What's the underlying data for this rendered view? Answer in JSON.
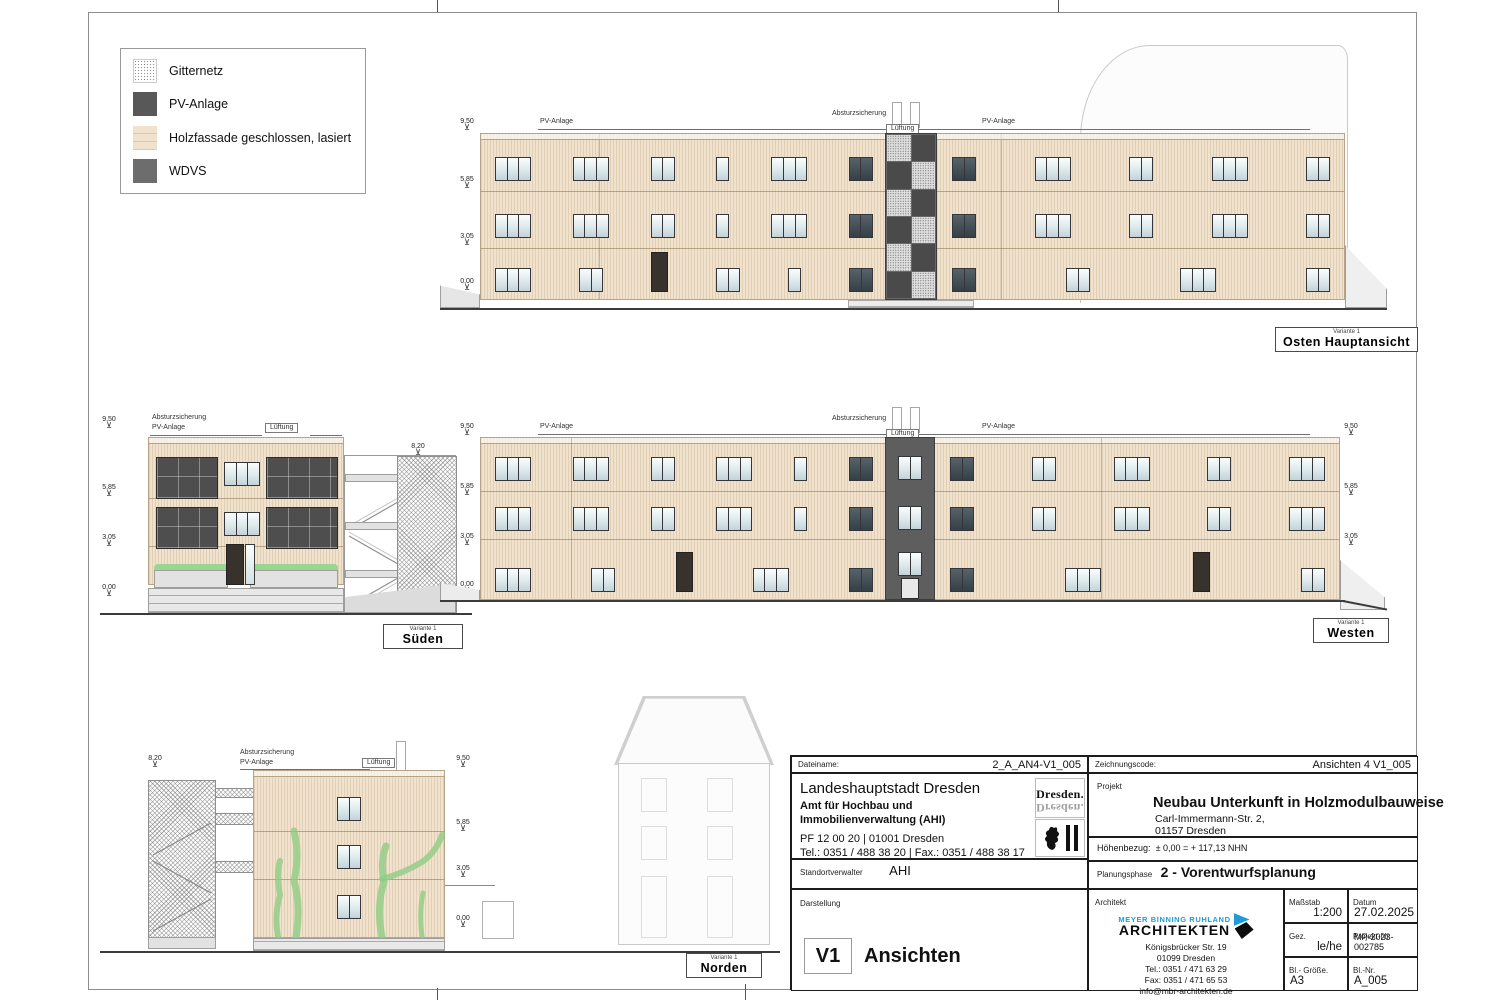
{
  "legend": {
    "items": [
      {
        "label": "Gitternetz"
      },
      {
        "label": "PV-Anlage"
      },
      {
        "label": "Holzfassade geschlossen, lasiert"
      },
      {
        "label": "WDVS"
      }
    ]
  },
  "annotations": {
    "pv_anlage": "PV-Anlage",
    "absturzsicherung": "Absturzsicherung",
    "lueftung": "Lüftung",
    "pflanztrog": "Pflanztrog"
  },
  "levels": {
    "roof": "9,50",
    "l2": "5,85",
    "l1": "3,05",
    "ground": "0,00",
    "tower": "8,20"
  },
  "icons": {
    "level_mark": "⊻"
  },
  "views": {
    "osten": {
      "variant": "Variante 1",
      "title": "Osten Hauptansicht"
    },
    "sueden": {
      "variant": "Variante 1",
      "title": "Süden"
    },
    "westen": {
      "variant": "Variante 1",
      "title": "Westen"
    },
    "norden": {
      "variant": "Variante 1",
      "title": "Norden"
    }
  },
  "titleblock": {
    "dateiname_label": "Dateiname:",
    "dateiname_value": "2_A_AN4-V1_005",
    "zeichnungscode_label": "Zeichnungscode:",
    "zeichnungscode_value": "Ansichten 4 V1_005",
    "client": {
      "name": "Landeshauptstadt Dresden",
      "dept": "Amt für Hochbau und Immobilienverwaltung (AHI)",
      "address": "PF 12 00 20 | 01001 Dresden",
      "phone": "Tel.: 0351 / 488 38 20 | Fax.: 0351 / 488 38 17",
      "logo_text": "Dresden."
    },
    "projekt_label": "Projekt",
    "projekt_name": "Neubau Unterkunft in Holzmodulbauweise",
    "projekt_addr1": "Carl-Immermann-Str. 2,",
    "projekt_addr2": "01157 Dresden",
    "hoehenbezug_label": "Höhenbezug:",
    "hoehenbezug_value": "± 0,00 = + 117,13 NHN",
    "standortverwalter_label": "Standortverwalter",
    "standortverwalter_value": "AHI",
    "planungsphase_label": "Planungsphase",
    "planungsphase_value": "2 - Vorentwurfsplanung",
    "darstellung_label": "Darstellung",
    "darstellung_code": "V1",
    "darstellung_value": "Ansichten",
    "architekt_label": "Architekt",
    "architekt": {
      "logo_line1": "MEYER BINNING RUHLAND",
      "logo_line2": "ARCHITEKTEN",
      "addr1": "Königsbrücker Str. 19",
      "addr2": "01099 Dresden",
      "tel": "Tel.: 0351 / 471 63 29",
      "fax": "Fax: 0351 / 471 65 53",
      "email": "info@mbr-architekten.de"
    },
    "massstab_label": "Maßstab",
    "massstab_value": "1:200",
    "datum_label": "Datum",
    "datum_value": "27.02.2025",
    "gez_label": "Gez.",
    "gez_value": "le/he",
    "projektnr_label": "Projekt-Nr.",
    "projektnr_value": "MP-2023-002785",
    "blgroesse_label": "Bl.- Größe.",
    "blgroesse_value": "A3",
    "blnr_label": "Bl.-Nr.",
    "blnr_value": "A_005"
  },
  "colors": {
    "facade_wood": "#f0e2cc",
    "pv_dark": "#4e4e4e",
    "wdvs_gray": "#6d6d6d",
    "plant_green": "#8fcd85",
    "mbr_blue": "#1e9cd8"
  }
}
